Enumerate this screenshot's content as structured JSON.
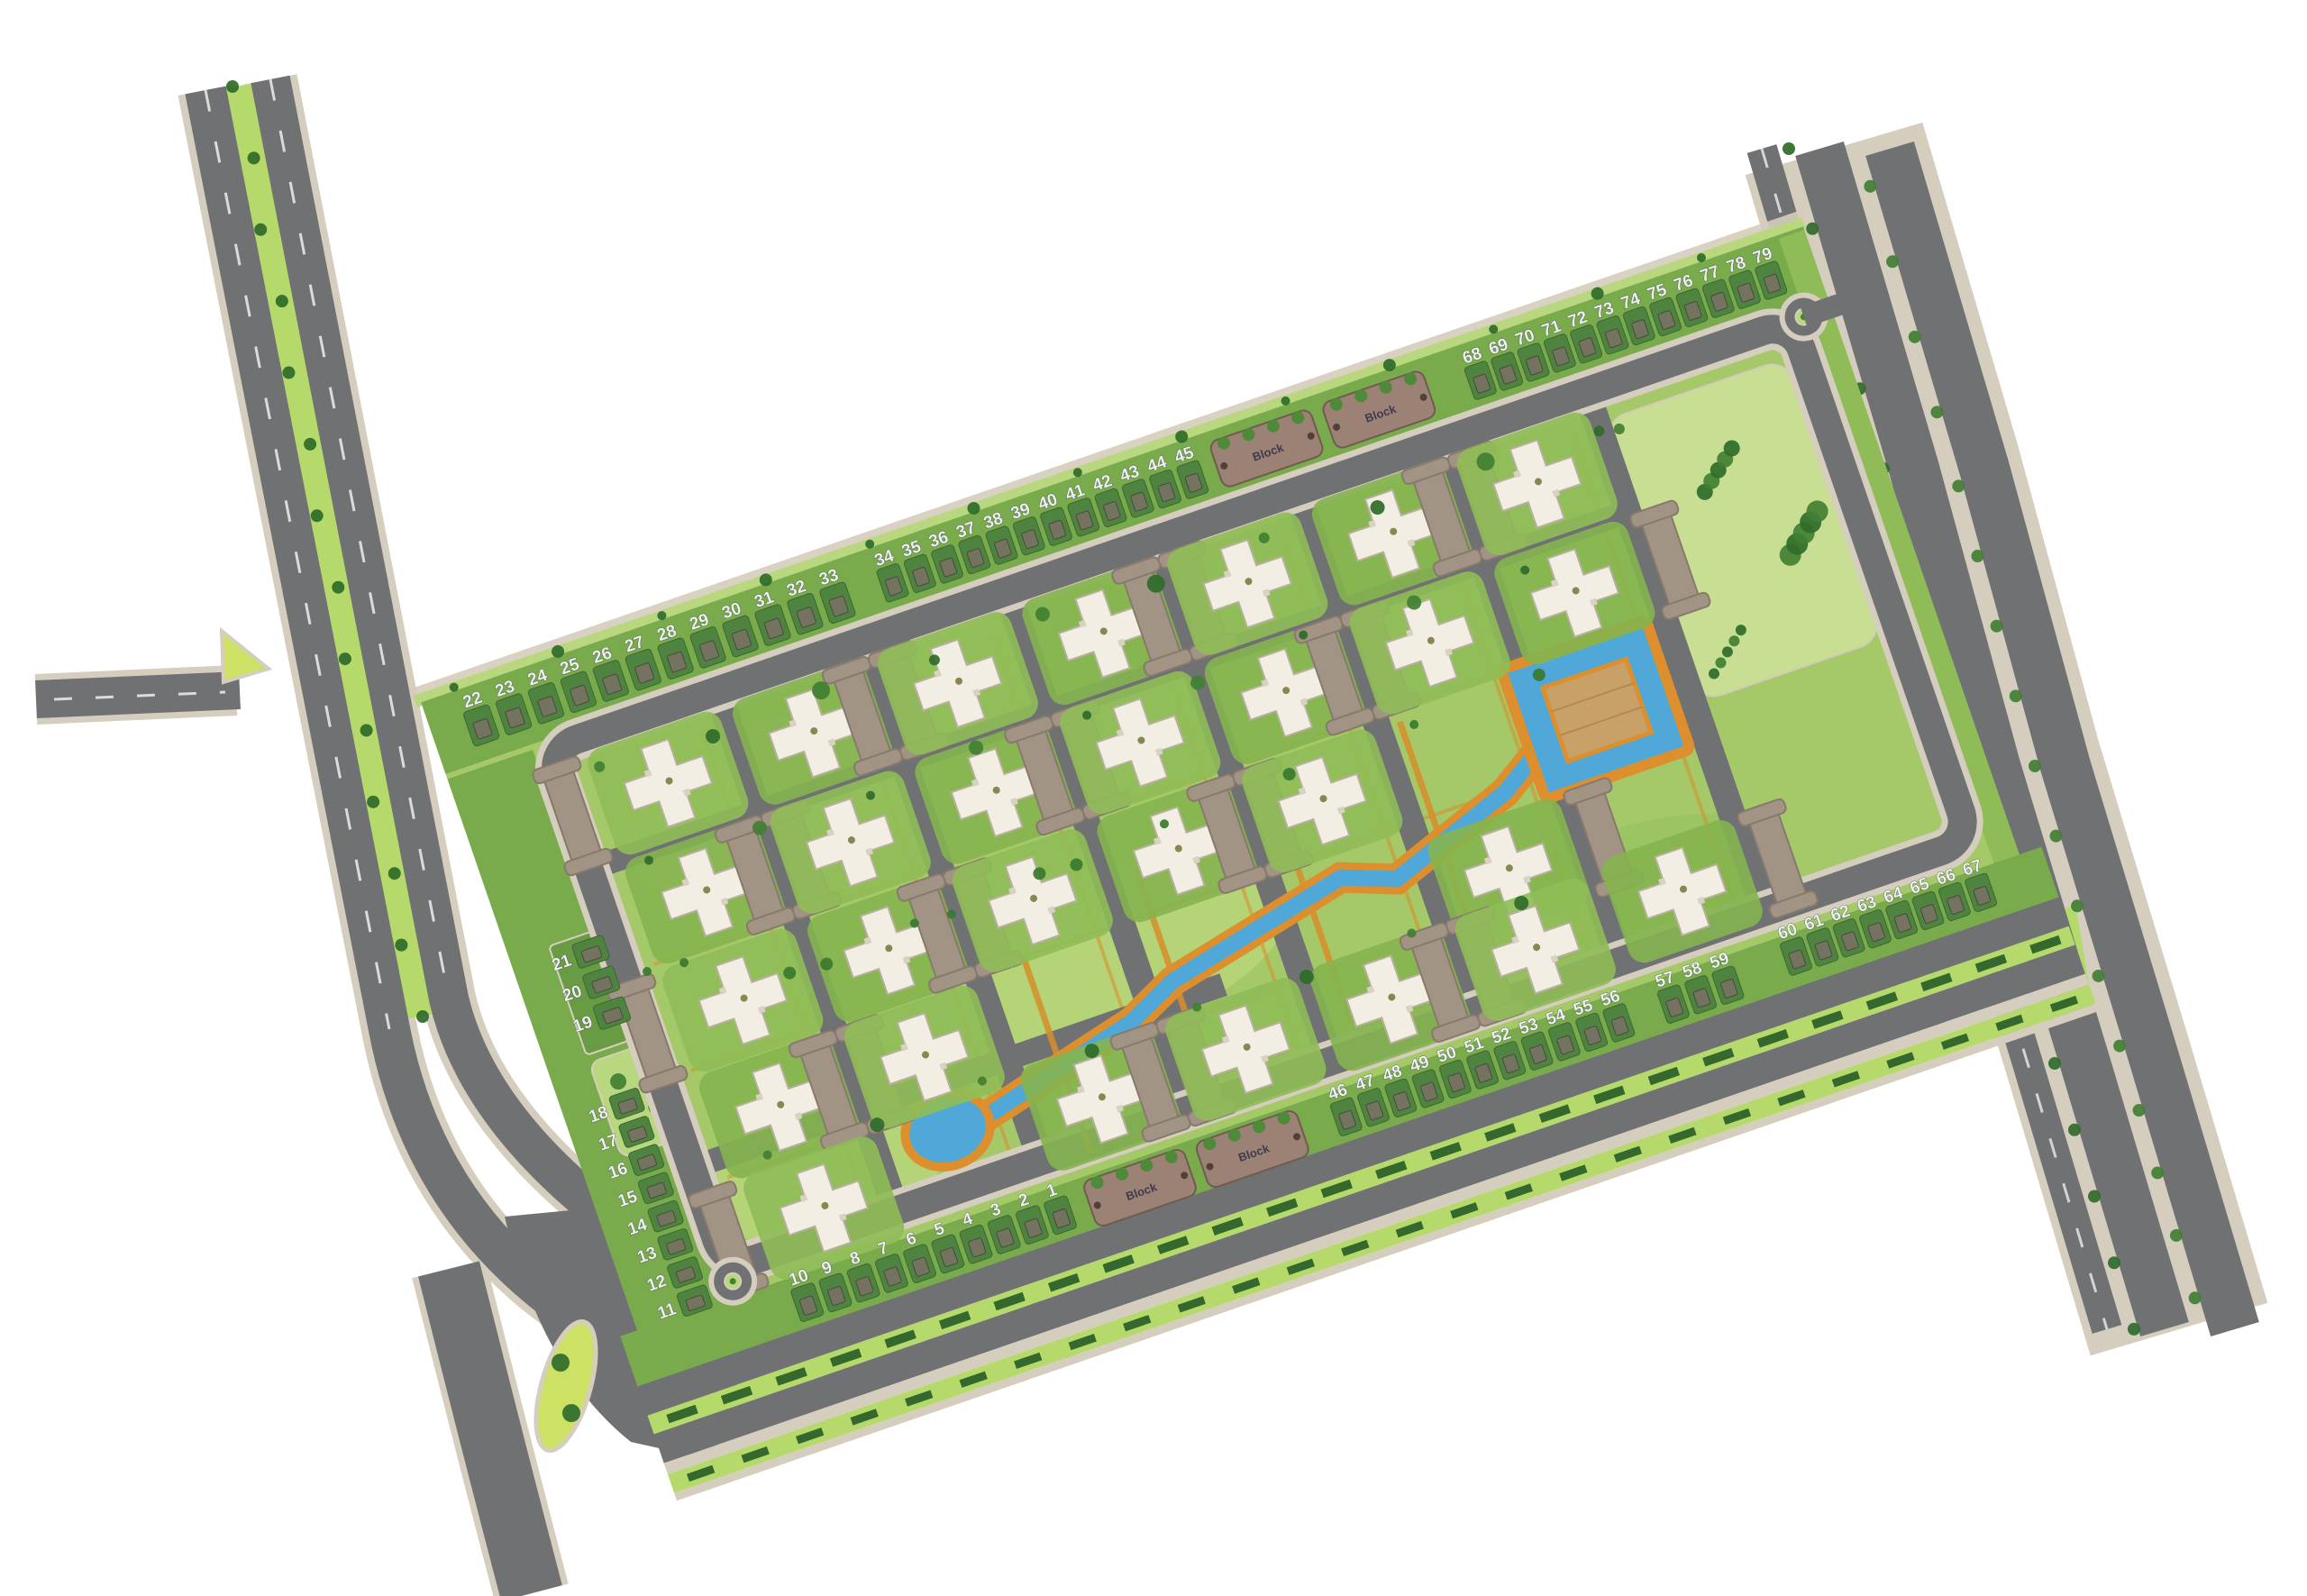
{
  "map": {
    "plot_strips": {
      "top_left": {
        "numbers": [
          "22",
          "23",
          "24",
          "25",
          "26",
          "27",
          "28",
          "29",
          "30",
          "31",
          "32",
          "33"
        ]
      },
      "top_mid": {
        "numbers": [
          "34",
          "35",
          "36",
          "37",
          "38",
          "39",
          "40",
          "41",
          "42",
          "43",
          "44",
          "45"
        ]
      },
      "top_right": {
        "numbers": [
          "68",
          "69",
          "70",
          "71",
          "72",
          "73",
          "74",
          "75",
          "76",
          "77",
          "78",
          "79"
        ]
      },
      "left_upper": {
        "numbers": [
          "21",
          "20",
          "19"
        ]
      },
      "left_col": {
        "numbers": [
          "18",
          "17",
          "16",
          "15",
          "14",
          "13",
          "12",
          "11"
        ]
      },
      "bottom_left": {
        "numbers": [
          "10",
          "9",
          "8",
          "7",
          "6",
          "5",
          "4",
          "3",
          "2",
          "1"
        ]
      },
      "bottom_mid_a": {
        "numbers": [
          "46",
          "47",
          "48",
          "49",
          "50",
          "51",
          "52",
          "53",
          "54",
          "55",
          "56"
        ]
      },
      "bottom_mid_b": {
        "numbers": [
          "57",
          "58",
          "59"
        ]
      },
      "bottom_right": {
        "numbers": [
          "60",
          "61",
          "62",
          "63",
          "64",
          "65",
          "66",
          "67"
        ]
      }
    },
    "block_strips": {
      "label": "Block",
      "count": 4
    },
    "colors": {
      "road": "#6f7173",
      "road_edge": "#d5cdbd",
      "grass": "#a5c968",
      "grass_band": "#79ab4c",
      "lawn": "#85b44f",
      "lawn_alt": "#8fbc57",
      "plot_green": "#4f8340",
      "park": "#c8de92",
      "water": "#4fa8d8",
      "promenade": "#dd8f2e",
      "plaza": "#c8a169",
      "building": "#f3eee3",
      "parking": "#a29485",
      "block_strip": "#9b8274",
      "median_lime": "#b5d96b",
      "island_lime": "#cde265",
      "tree_dark": "#2f6b2a",
      "tree_mid": "#417f33",
      "number_text": "#eef0f6"
    }
  }
}
